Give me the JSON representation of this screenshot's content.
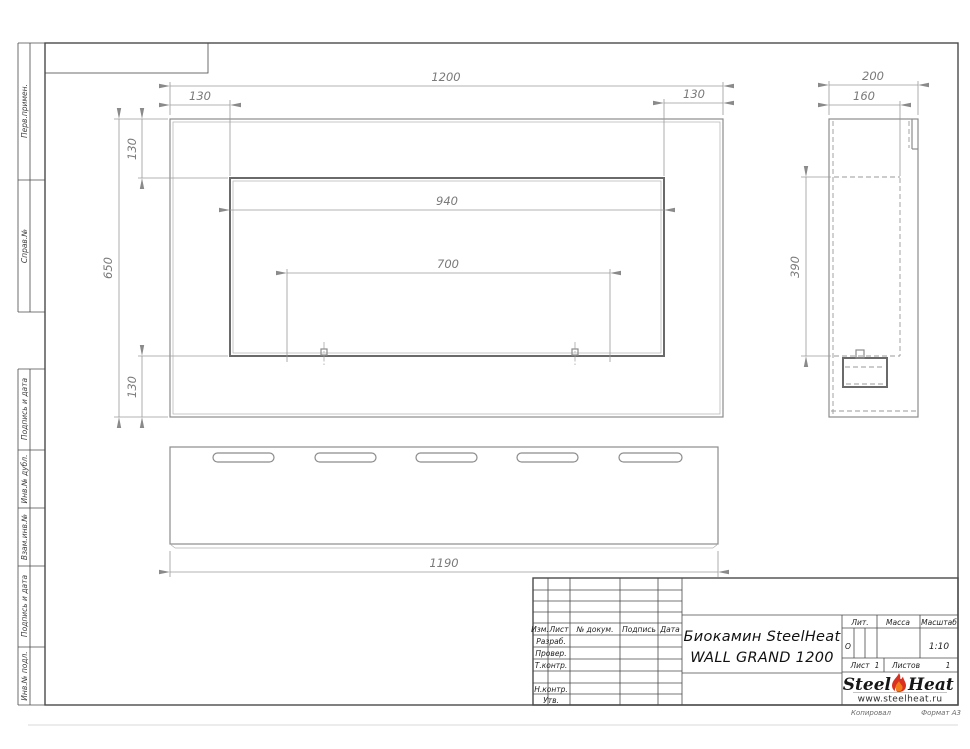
{
  "dims": {
    "front": {
      "overall_width": "1200",
      "overall_height": "650",
      "top_left_offset": "130",
      "top_right_offset": "130",
      "top_offset": "130",
      "bottom_offset": "130",
      "opening_width": "940",
      "burner_span": "700"
    },
    "side": {
      "depth": "200",
      "inner_depth": "160",
      "opening_height": "390"
    },
    "bottom": {
      "length": "1190"
    }
  },
  "margin": {
    "perv": "Перв.примен.",
    "sprav": "Справ.№",
    "podpis1": "Подпись и дата",
    "inv_dubl": "Инв.№ дубл.",
    "vzam": "Взам.инв.№",
    "podpis2": "Подпись и дата",
    "inv_podl": "Инв.№ подл."
  },
  "tb": {
    "columns": {
      "izm": "Изм.",
      "list": "Лист",
      "doc": "№ докум.",
      "podpis": "Подпись",
      "data": "Дата"
    },
    "rows": {
      "razrab": "Разраб.",
      "prover": "Провер.",
      "tkontr": "Т.контр.",
      "nkontr": "Н.контр.",
      "utv": "Утв."
    },
    "title_line1": "Биокамин SteelHeat",
    "title_line2": "WALL GRAND 1200",
    "lit_header": "Лит.",
    "lit_value": "О",
    "massa_header": "Масса",
    "masshtab_header": "Масштаб",
    "masshtab_value": "1:10",
    "list_label": "Лист",
    "list_value": "1",
    "listov_label": "Листов",
    "listov_value": "1",
    "logo_steel": "Steel",
    "logo_heat": "Heat",
    "logo_site": "www.steelheat.ru",
    "footer_left": "Копировал",
    "footer_right": "Формат А3"
  },
  "colors": {
    "flame_red": "#d93020",
    "flame_orange": "#f07d1a",
    "frame_line": "#4a4a4a",
    "dim_line": "#9a9a9a"
  }
}
